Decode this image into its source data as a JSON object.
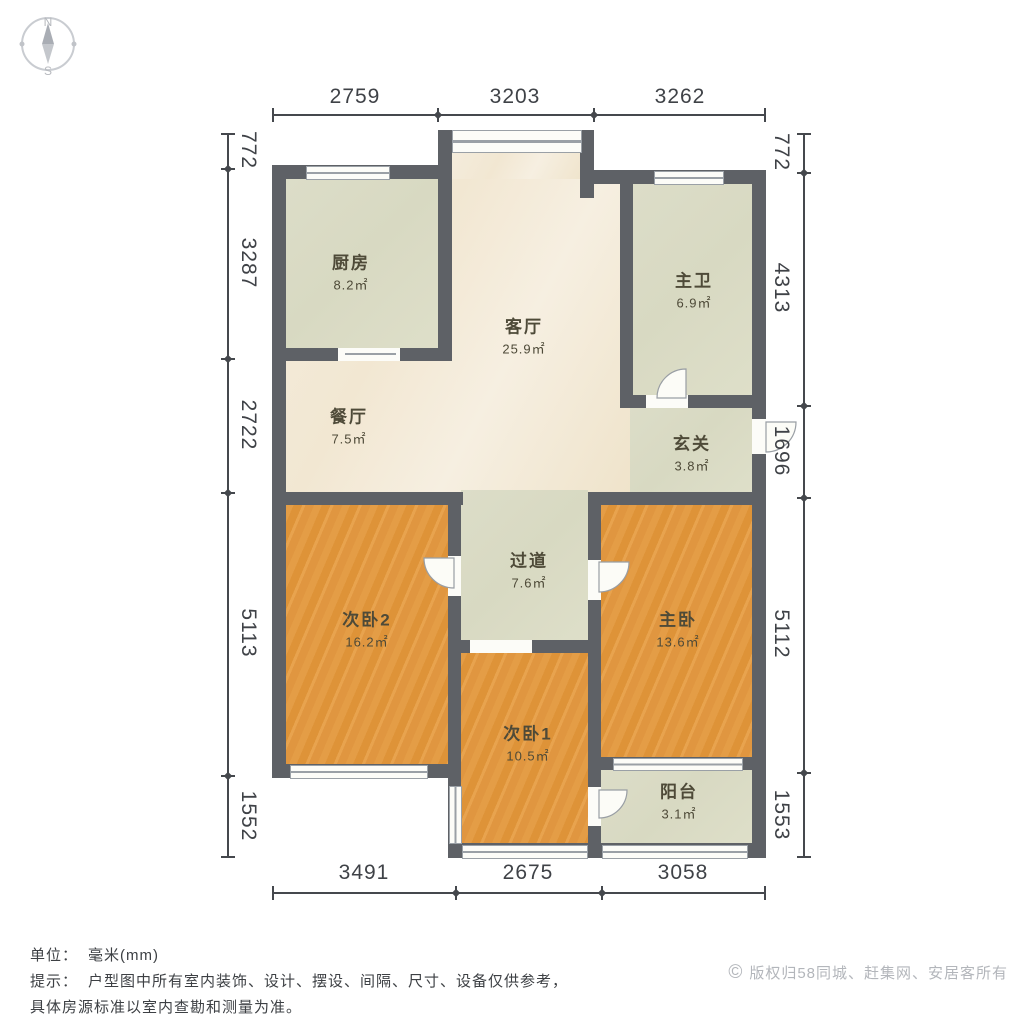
{
  "compass": {
    "north": "N",
    "south": "S"
  },
  "dimensions": {
    "top": [
      "2759",
      "3203",
      "3262"
    ],
    "bottom": [
      "3491",
      "2675",
      "3058"
    ],
    "left": [
      "772",
      "3287",
      "2722",
      "5113",
      "1552"
    ],
    "right": [
      "772",
      "4313",
      "1696",
      "5112",
      "1553"
    ]
  },
  "rooms": [
    {
      "name": "厨房",
      "area": "8.2㎡"
    },
    {
      "name": "客厅",
      "area": "25.9㎡"
    },
    {
      "name": "主卫",
      "area": "6.9㎡"
    },
    {
      "name": "餐厅",
      "area": "7.5㎡"
    },
    {
      "name": "玄关",
      "area": "3.8㎡"
    },
    {
      "name": "过道",
      "area": "7.6㎡"
    },
    {
      "name": "次卧2",
      "area": "16.2㎡"
    },
    {
      "name": "主卧",
      "area": "13.6㎡"
    },
    {
      "name": "次卧1",
      "area": "10.5㎡"
    },
    {
      "name": "阳台",
      "area": "3.1㎡"
    }
  ],
  "footer": {
    "unit_label": "单位：",
    "unit_value": "毫米(mm)",
    "note_label": "提示：",
    "note_line1": "户型图中所有室内装饰、设计、摆设、间隔、尺寸、设备仅供参考，",
    "note_line2": "具体房源标准以室内查勘和测量为准。",
    "copyright_symbol": "©",
    "copyright_text": "版权归58同城、赶集网、安居客所有"
  },
  "colors": {
    "wall": "#5e6166",
    "floor_wood": "#e1973d",
    "floor_tile": "#dbdcc6",
    "floor_marble": "#f3ead8",
    "dimension": "#45484d",
    "copyright": "#b3b6bb"
  }
}
